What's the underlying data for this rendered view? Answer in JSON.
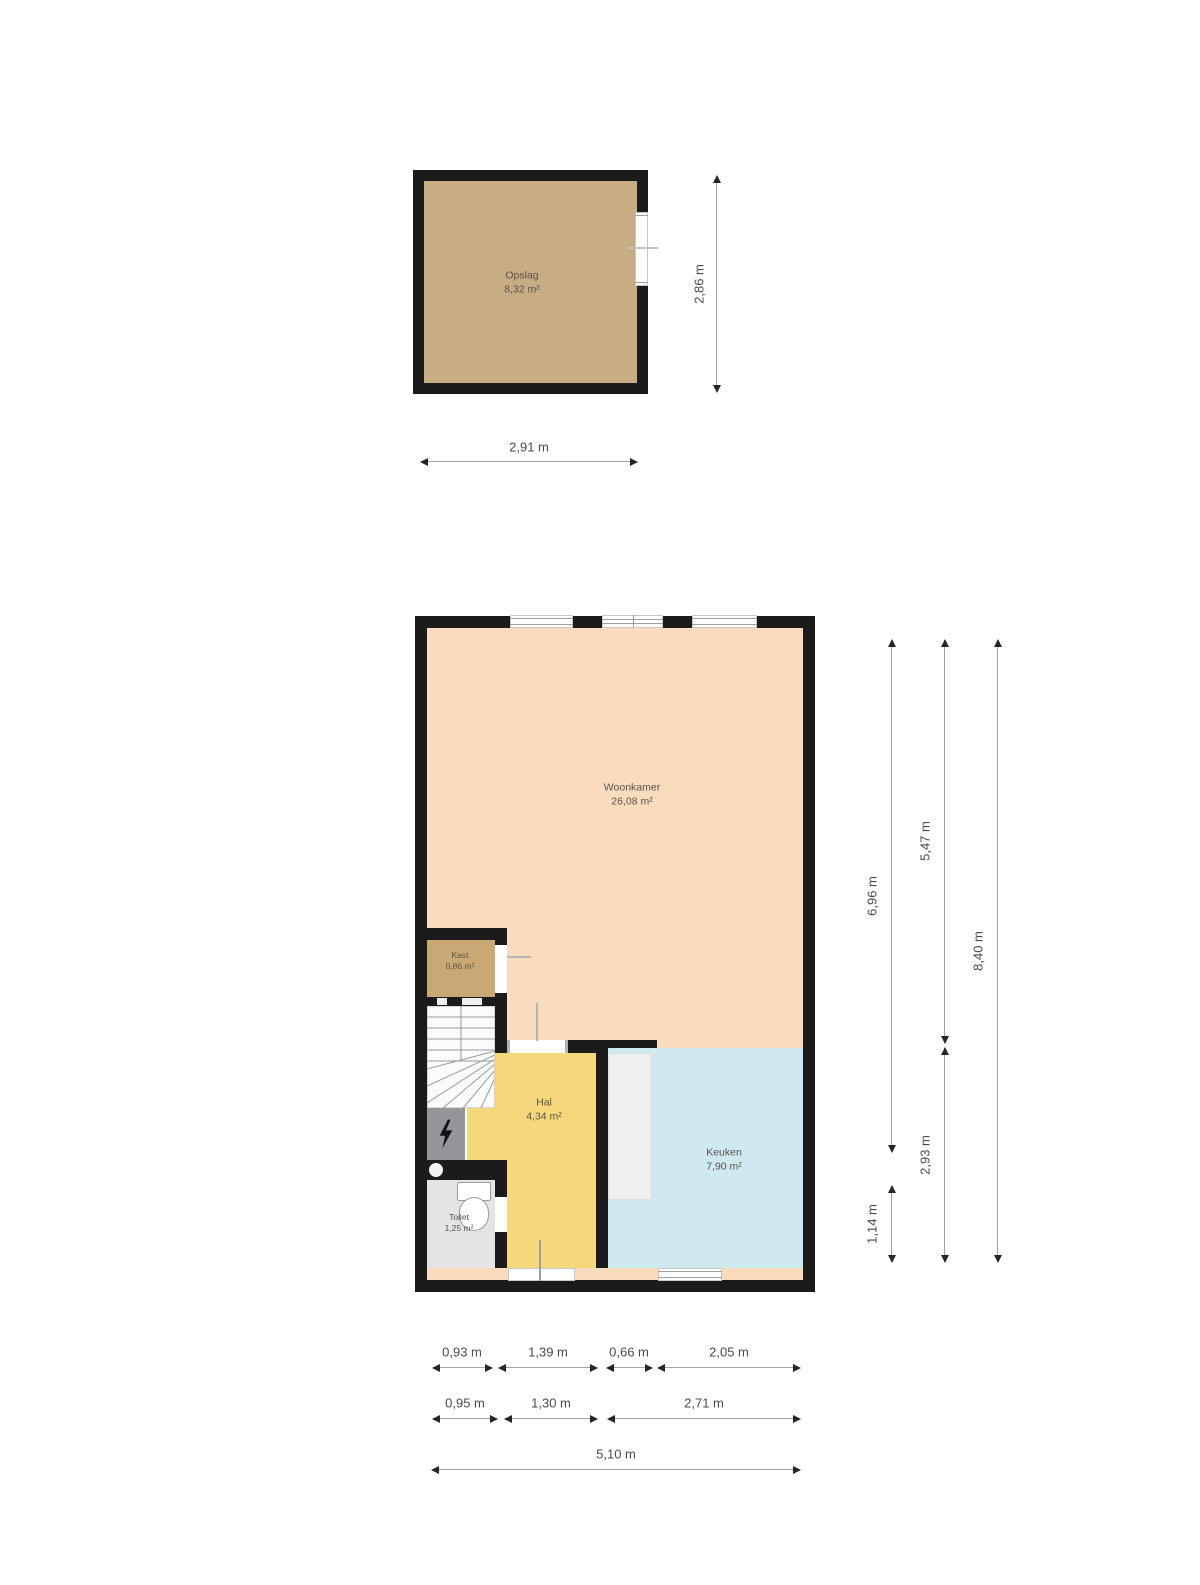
{
  "colors": {
    "wall": "#1b1b1b",
    "woonkamer": "#f9dcbd",
    "hal": "#f6d87c",
    "keuken": "#cfe9f1",
    "kast": "#c9a873",
    "opslag": "#c7ac84",
    "toilet": "#e4e4e7",
    "counter": "#efefef",
    "stairs": "#fbfbfb",
    "meter_closet": "#96969a"
  },
  "storage_floor": {
    "room": {
      "name": "Opslag",
      "area": "8,32 m²"
    },
    "dims": {
      "width": "2,91 m",
      "height": "2,86 m"
    }
  },
  "ground_floor": {
    "rooms": {
      "woonkamer": {
        "name": "Woonkamer",
        "area": "26,08 m²"
      },
      "kast": {
        "name": "Kast",
        "area": "0,86 m²"
      },
      "hal": {
        "name": "Hal",
        "area": "4,34 m²"
      },
      "toilet": {
        "name": "Toilet",
        "area": "1,25 m²"
      },
      "keuken": {
        "name": "Keuken",
        "area": "7,90 m²"
      }
    },
    "dims": {
      "right_inner_top": "6,96 m",
      "right_inner_bottom": "1,14 m",
      "right_mid_top": "5,47 m",
      "right_mid_bottom": "2,93 m",
      "right_total": "8,40 m",
      "bottom_row1": [
        "0,93 m",
        "1,39 m",
        "0,66 m",
        "2,05 m"
      ],
      "bottom_row2": [
        "0,95 m",
        "1,30 m",
        "2,71 m"
      ],
      "bottom_total": "5,10 m"
    }
  }
}
